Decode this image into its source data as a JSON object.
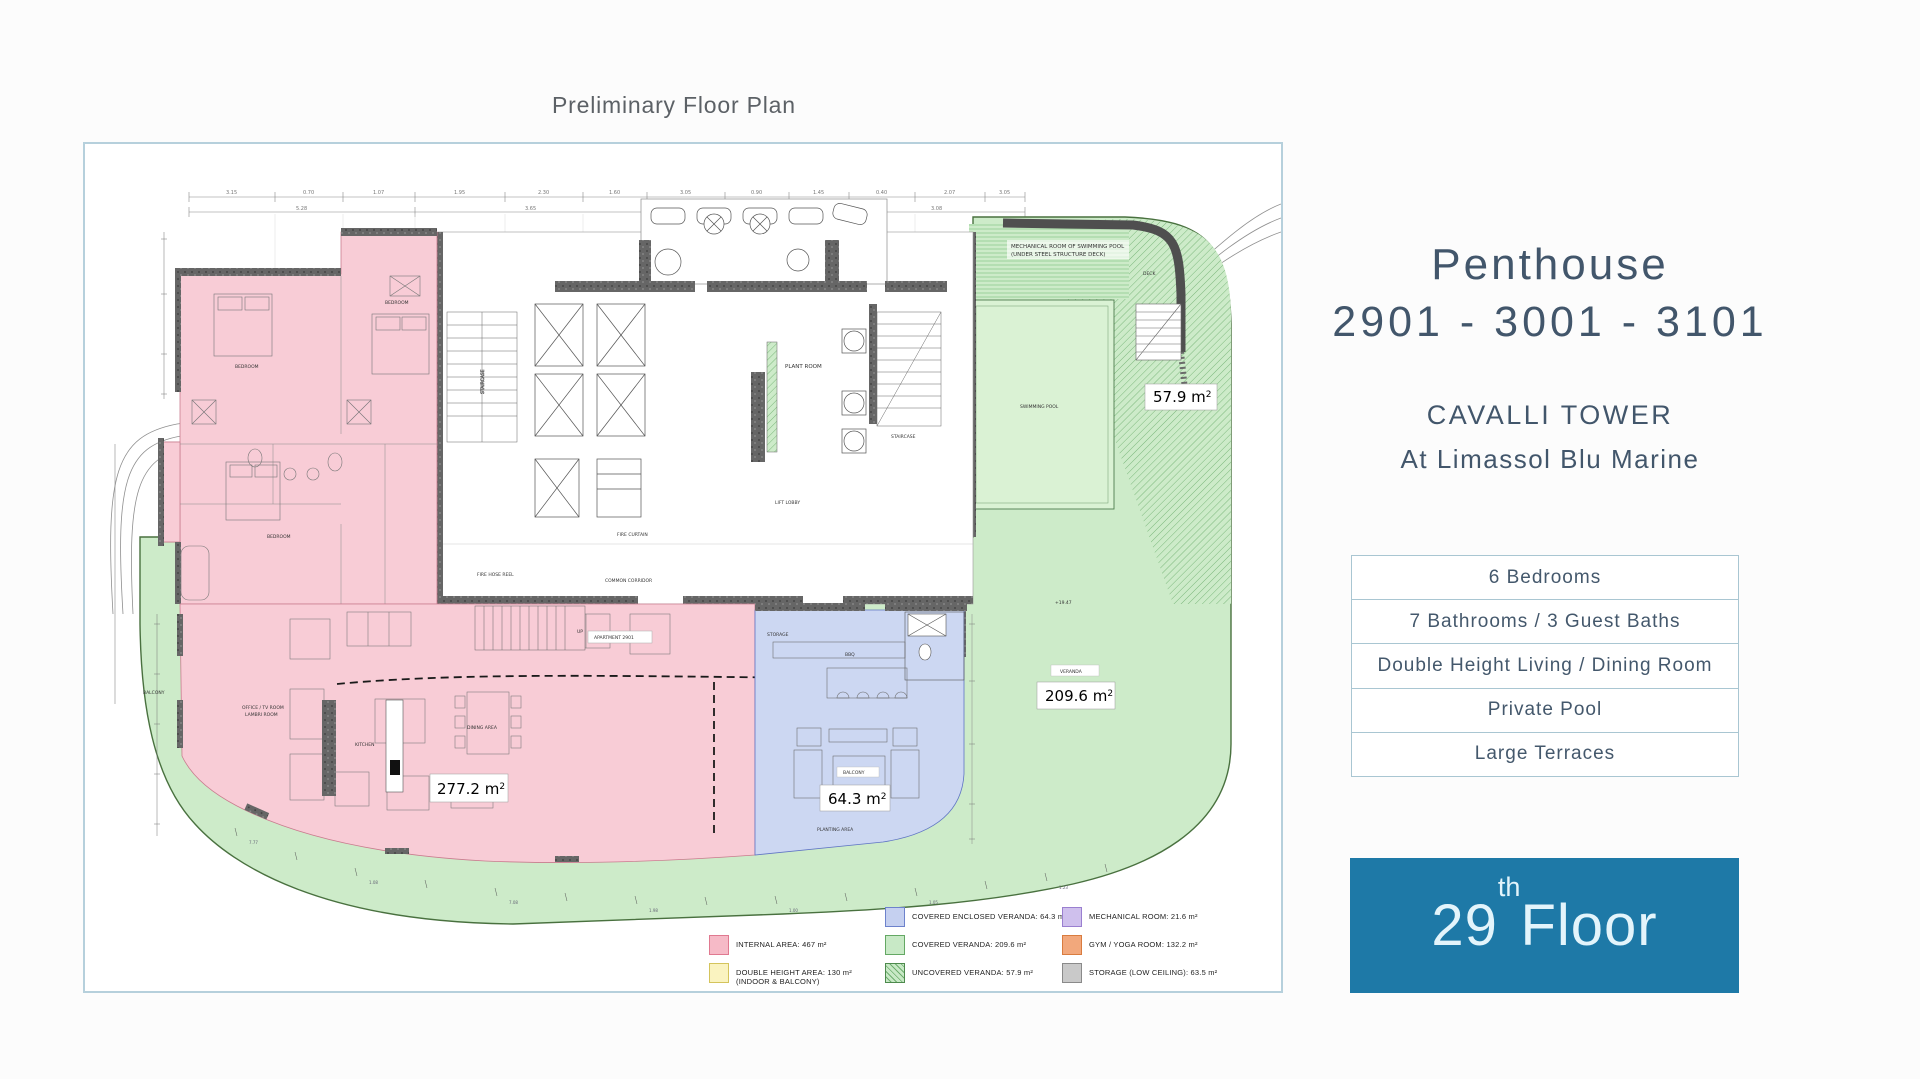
{
  "page": {
    "title": "Preliminary Floor Plan",
    "background": "#fcfcfc"
  },
  "plan": {
    "border_color": "#b6d0dc",
    "area_labels": {
      "internal": {
        "text": "277.2 m",
        "sup": "2"
      },
      "enclosed": {
        "text": "64.3 m",
        "sup": "2"
      },
      "covered": {
        "text": "209.6 m",
        "sup": "2"
      },
      "uncovered": {
        "text": "57.9 m",
        "sup": "2"
      }
    },
    "rooms": {
      "mech1": "MECHANICAL ROOM OF SWIMMING POOL",
      "mech2": "(UNDER STEEL STRUCTURE DECK)",
      "deck": "DECK",
      "pool": "SWIMMING POOL",
      "veranda": "VERANDA",
      "balcony": "BALCONY",
      "balcony_rug": "BALCONY",
      "planting": "PLANTING AREA",
      "plant_room": "PLANT ROOM",
      "staircase": "STAIRCASE",
      "staircase2": "STAIRCASE",
      "lift_lobby": "LIFT LOBBY",
      "common_corridor": "COMMON CORRIDOR",
      "fire_curtain": "FIRE CURTAIN",
      "fire_hose": "FIRE HOSE REEL",
      "apartment": "APARTMENT 2901",
      "up": "UP",
      "kitchen": "KITCHEN",
      "dining": "DINING AREA",
      "office1": "OFFICE / TV ROOM",
      "office2": "LAMBRI ROOM",
      "bedroom1": "BEDROOM",
      "bedroom2": "BEDROOM",
      "bedroom3": "BEDROOM",
      "storage": "STORAGE",
      "bbq": "BBQ",
      "elevation": "+19.47"
    },
    "dims": {
      "top": [
        "3.15",
        "0.70",
        "1.07",
        "1.95",
        "2.30",
        "1.60",
        "3.05",
        "0.90",
        "1.45",
        "0.40",
        "2.07",
        "3.05"
      ],
      "top2": [
        "5.28",
        "3.65",
        "3.00",
        "3.08"
      ],
      "bottom": [
        "7.77",
        "1.08",
        "7.08",
        "1.98",
        "1.00",
        "1.05",
        "1.23"
      ]
    },
    "legend": {
      "items": [
        {
          "label": "COVERED ENCLOSED VERANDA: 64.3 m²",
          "color": "#c5d0f0"
        },
        {
          "label": "MECHANICAL ROOM: 21.6 m²",
          "color": "#cfc0ed"
        },
        {
          "label": "INTERNAL AREA: 467 m²",
          "color": "#f6bac7"
        },
        {
          "label": "COVERED VERANDA: 209.6 m²",
          "color": "#c8e9c6"
        },
        {
          "label": "GYM / YOGA ROOM: 132.2 m²",
          "color": "#f2a87c"
        },
        {
          "label": "DOUBLE HEIGHT AREA: 130 m²",
          "sublabel": "(INDOOR & BALCONY)",
          "color": "#faf3c0"
        },
        {
          "label": "UNCOVERED VERANDA: 57.9 m²",
          "color": "#c8e9c6",
          "hatched": true
        },
        {
          "label": "STORAGE (LOW CEILING): 63.5 m²",
          "color": "#c9c9c9"
        }
      ]
    }
  },
  "panel": {
    "title": "Penthouse",
    "units": "2901 - 3001 - 3101",
    "building": "CAVALLI TOWER",
    "location": "At Limassol Blu Marine",
    "features": [
      "6 Bedrooms",
      "7 Bathrooms / 3 Guest Baths",
      "Double Height Living / Dining Room",
      "Private Pool",
      "Large Terraces"
    ],
    "floor": {
      "number": "29",
      "suffix": "th",
      "word": "Floor"
    },
    "banner_color": "#1e79a7",
    "text_color": "#42566b"
  }
}
